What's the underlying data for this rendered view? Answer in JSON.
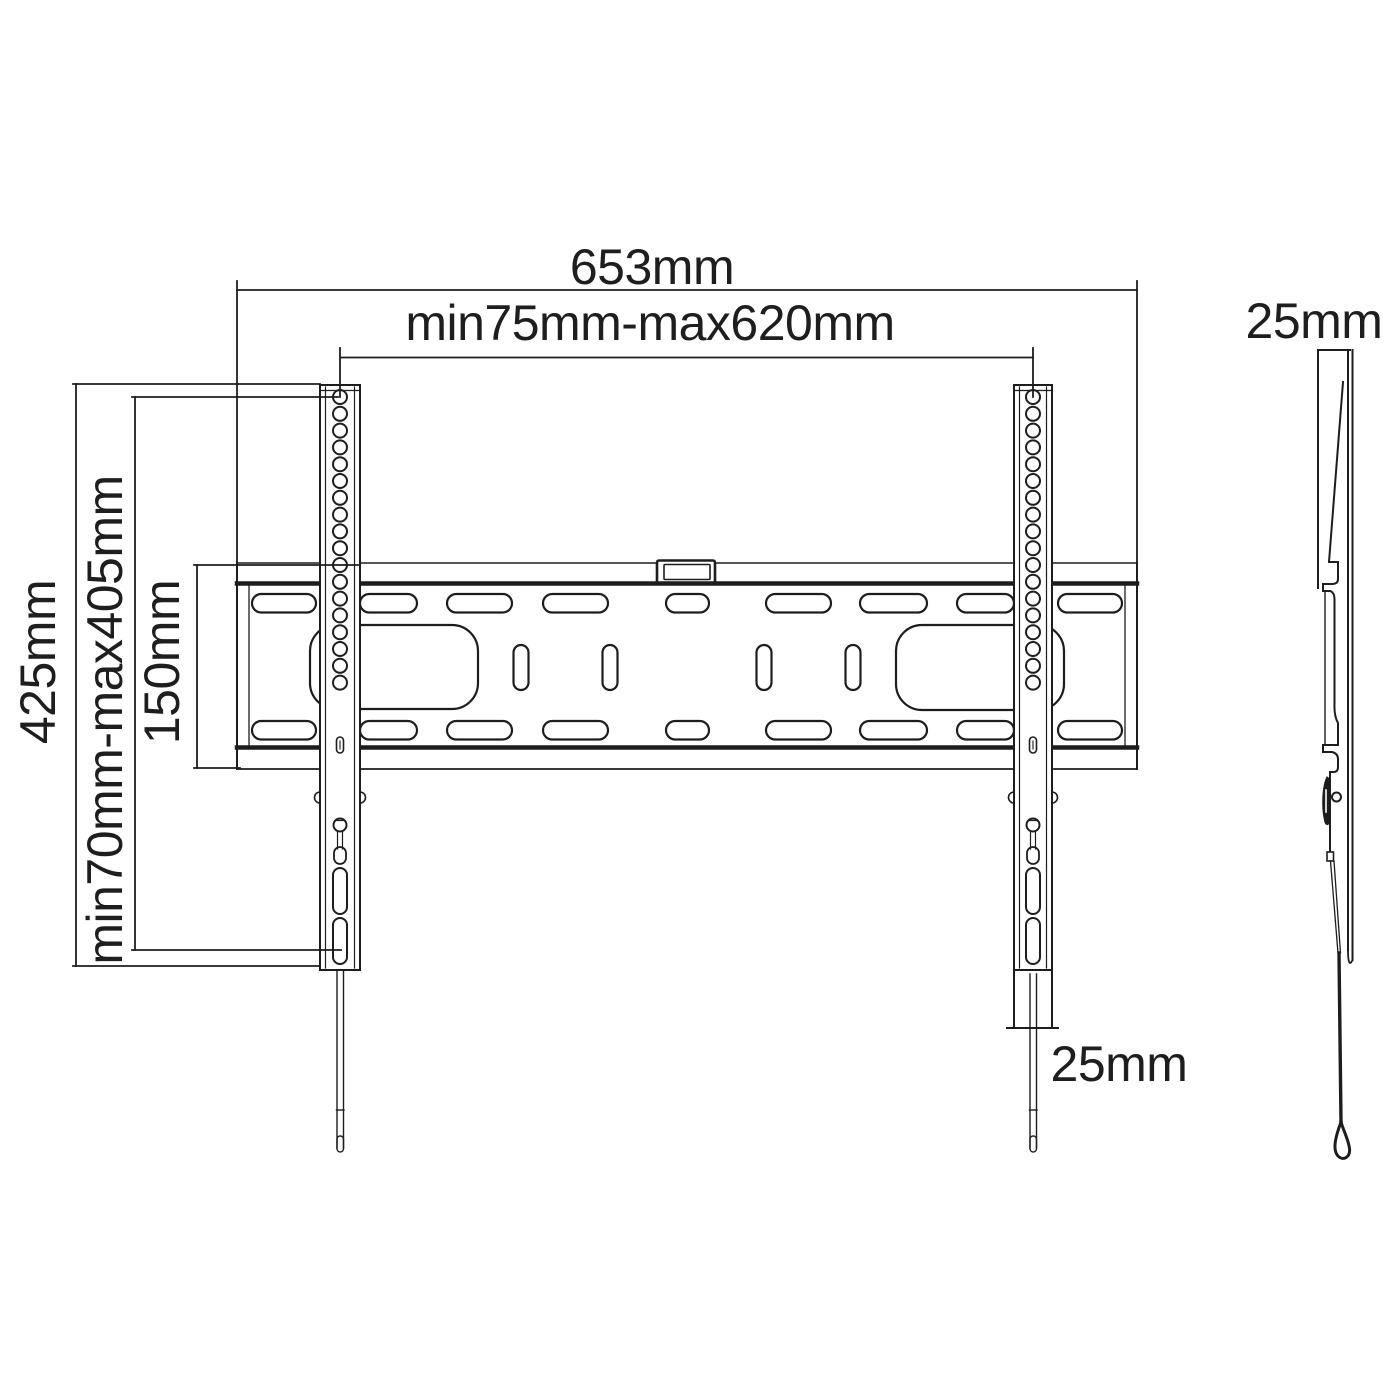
{
  "drawing": {
    "type": "technical dimension drawing",
    "subject": "TV wall mount bracket (front view and side view)",
    "labels": {
      "overall_width": "653mm",
      "mount_width_range": "min75mm-max620mm",
      "overall_height": "425mm",
      "mount_height_range": "min70mm-max405mm",
      "plate_height": "150mm",
      "side_depth": "25mm",
      "rail_bottom_offset": "25mm"
    },
    "colors": {
      "line": "#1d1d1d",
      "background": "#ffffff"
    }
  }
}
